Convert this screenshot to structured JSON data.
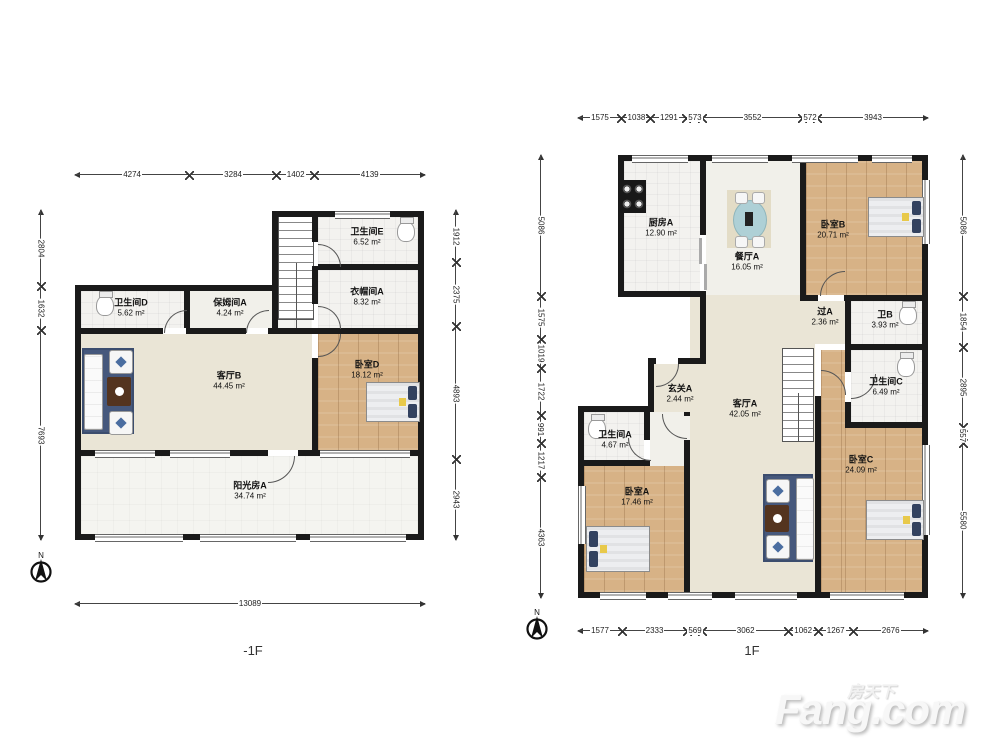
{
  "floorplan": {
    "watermark": {
      "cn": "房天下",
      "en": "Fang.com"
    },
    "compass_letter": "N",
    "plans": [
      {
        "label": "-1F",
        "rooms": [
          {
            "name": "卫生间E",
            "area": "6.52 m²"
          },
          {
            "name": "衣帽间A",
            "area": "8.32 m²"
          },
          {
            "name": "卫生间D",
            "area": "5.62 m²"
          },
          {
            "name": "保姆间A",
            "area": "4.24 m²"
          },
          {
            "name": "客厅B",
            "area": "44.45 m²"
          },
          {
            "name": "卧室D",
            "area": "18.12 m²"
          },
          {
            "name": "阳光房A",
            "area": "34.74 m²"
          }
        ],
        "dims_top": [
          "4274",
          "3284",
          "1402",
          "4139"
        ],
        "dims_left": [
          "2804",
          "1632",
          "7693"
        ],
        "dims_right": [
          "1912",
          "2375",
          "4893",
          "2943"
        ],
        "dims_bottom": [
          "13089"
        ]
      },
      {
        "label": "1F",
        "rooms": [
          {
            "name": "厨房A",
            "area": "12.90 m²"
          },
          {
            "name": "餐厅A",
            "area": "16.05 m²"
          },
          {
            "name": "卧室B",
            "area": "20.71 m²"
          },
          {
            "name": "过A",
            "area": "2.36 m²"
          },
          {
            "name": "卫B",
            "area": "3.93 m²"
          },
          {
            "name": "卫生间C",
            "area": "6.49 m²"
          },
          {
            "name": "玄关A",
            "area": "2.44 m²"
          },
          {
            "name": "客厅A",
            "area": "42.05 m²"
          },
          {
            "name": "卫生间A",
            "area": "4.67 m²"
          },
          {
            "name": "卧室A",
            "area": "17.46 m²"
          },
          {
            "name": "卧室C",
            "area": "24.09 m²"
          }
        ],
        "dims_top": [
          "1575",
          "1038",
          "1291",
          "573",
          "3552",
          "572",
          "3943"
        ],
        "dims_left": [
          "5086",
          "1575",
          "1019",
          "1722",
          "991",
          "1217",
          "4363"
        ],
        "dims_right": [
          "5086",
          "1854",
          "2895",
          "557",
          "5580"
        ],
        "dims_bottom": [
          "1577",
          "2333",
          "569",
          "3062",
          "1062",
          "1267",
          "2676"
        ]
      }
    ]
  }
}
